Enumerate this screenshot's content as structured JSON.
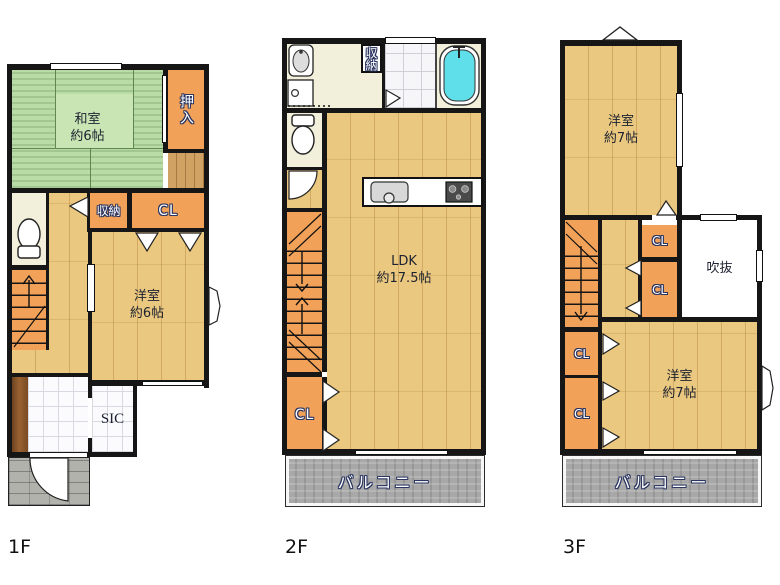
{
  "floors": [
    {
      "label": "1F",
      "rooms": {
        "washitsu": {
          "name": "和室",
          "size": "約6帖"
        },
        "oshiire": "押入",
        "shuno": "収納",
        "cl": "CL",
        "yoshitsu": {
          "name": "洋室",
          "size": "約6帖"
        },
        "sic": "SIC"
      }
    },
    {
      "label": "2F",
      "rooms": {
        "shuno": "収納",
        "ldk": {
          "name": "LDK",
          "size": "約17.5帖"
        },
        "cl": "CL",
        "balcony": "バルコニー"
      }
    },
    {
      "label": "3F",
      "rooms": {
        "bedroom_top": {
          "name": "洋室",
          "size": "約7帖"
        },
        "cl_mid_top": "CL",
        "cl_mid_bottom": "CL",
        "fukinuke": "吹抜",
        "cl_left_top": "CL",
        "cl_left_bottom": "CL",
        "bedroom_bottom": {
          "name": "洋室",
          "size": "約7帖"
        },
        "balcony": "バルコニー"
      }
    }
  ],
  "colors": {
    "wall": "#161616",
    "tatami_green": "#b9dba6",
    "wood_floor": "#ebc87f",
    "closet_orange": "#f2a158",
    "utility_cream": "#f2efda",
    "tile_white": "#fbfbfd",
    "balcony_gray": "#a8a8a8",
    "porch_gray": "#b2b2ad",
    "tub_cyan": "#5fdfe9",
    "label_outline_navy": "#2a3560"
  },
  "icons": {
    "toilet": "toilet-icon",
    "washbasin": "washbasin-icon",
    "washing_machine": "washing-machine-icon",
    "bathtub": "bathtub-icon",
    "kitchen_sink": "kitchen-sink-icon",
    "stove": "stove-icon",
    "stairs_arrow": "stairs-arrow-icon",
    "door_swing": "door-swing-arc-icon",
    "door_triangle": "door-triangle-icon",
    "window": "window-icon",
    "gable_vent": "gable-vent-icon"
  }
}
